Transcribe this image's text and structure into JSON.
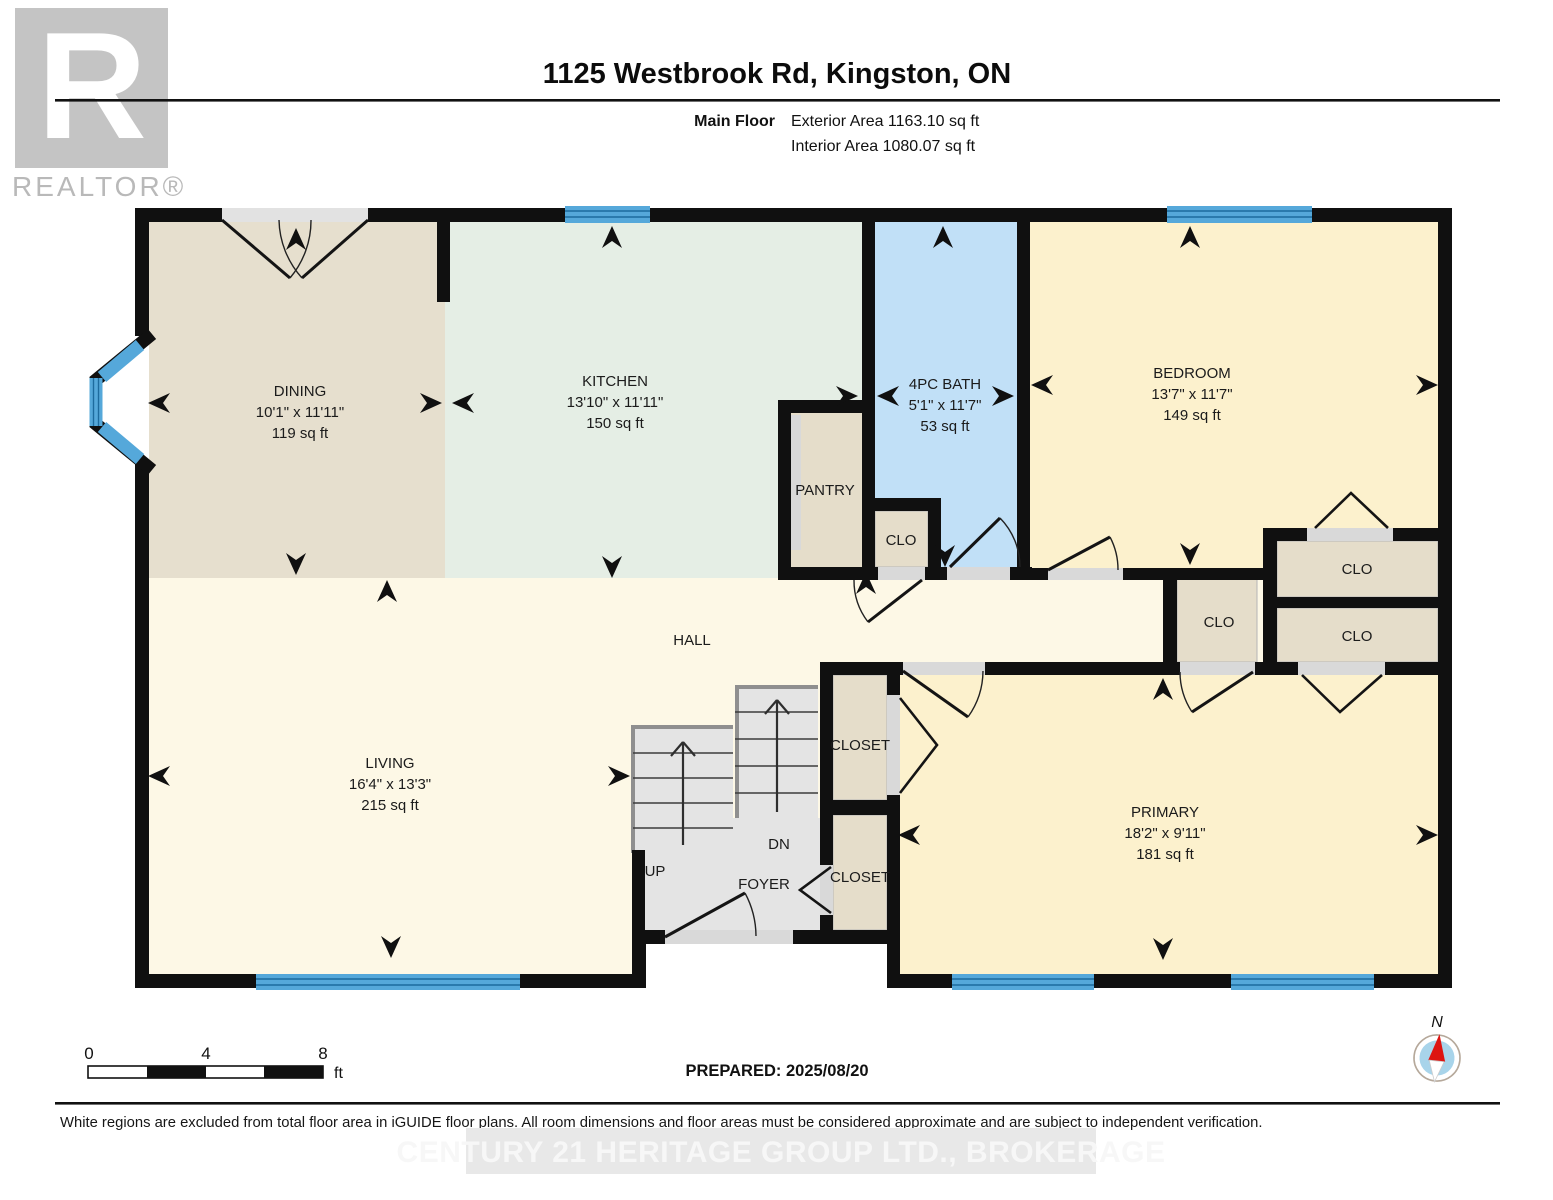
{
  "header": {
    "title": "1125 Westbrook Rd, Kingston, ON",
    "floor_label": "Main Floor",
    "exterior_area": "Exterior Area 1163.10 sq ft",
    "interior_area": "Interior Area 1080.07 sq ft"
  },
  "logo": {
    "letter": "R",
    "wordmark": "REALTOR®"
  },
  "rooms": {
    "dining": {
      "name": "DINING",
      "dims": "10'1\" x 11'11\"",
      "area": "119 sq ft"
    },
    "kitchen": {
      "name": "KITCHEN",
      "dims": "13'10\" x 11'11\"",
      "area": "150 sq ft"
    },
    "bath": {
      "name": "4PC BATH",
      "dims": "5'1\" x 11'7\"",
      "area": "53 sq ft"
    },
    "bedroom": {
      "name": "BEDROOM",
      "dims": "13'7\" x 11'7\"",
      "area": "149 sq ft"
    },
    "living": {
      "name": "LIVING",
      "dims": "16'4\" x 13'3\"",
      "area": "215 sq ft"
    },
    "primary": {
      "name": "PRIMARY",
      "dims": "18'2\" x 9'11\"",
      "area": "181 sq ft"
    },
    "hall": {
      "name": "HALL"
    },
    "pantry": {
      "name": "PANTRY"
    },
    "foyer": {
      "name": "FOYER"
    },
    "stairs": {
      "up": "UP",
      "dn": "DN"
    },
    "labels": {
      "clo": "CLO",
      "closet": "CLOSET"
    }
  },
  "scale_bar": {
    "start": "0",
    "mid": "4",
    "end": "8",
    "unit": "ft"
  },
  "prepared_label": "PREPARED: 2025/08/20",
  "compass": {
    "north": "N"
  },
  "footer": {
    "disclaimer": "White regions are excluded from total floor area in iGUIDE floor plans. All room dimensions and floor areas must be considered approximate and are subject to independent verification.",
    "watermark": "CENTURY 21 HERITAGE GROUP LTD., BROKERAGE"
  },
  "colors": {
    "wall": "#101010",
    "dining": "#e6dfce",
    "kitchen": "#e5eee5",
    "bath": "#c1e0f7",
    "bedroom": "#fcf1cd",
    "hall": "#fdf8e6",
    "closet_tan": "#e5ddca",
    "stair_gray": "#e4e4e4",
    "window_blue": "#55a8da",
    "compass_red": "#dd1411"
  }
}
